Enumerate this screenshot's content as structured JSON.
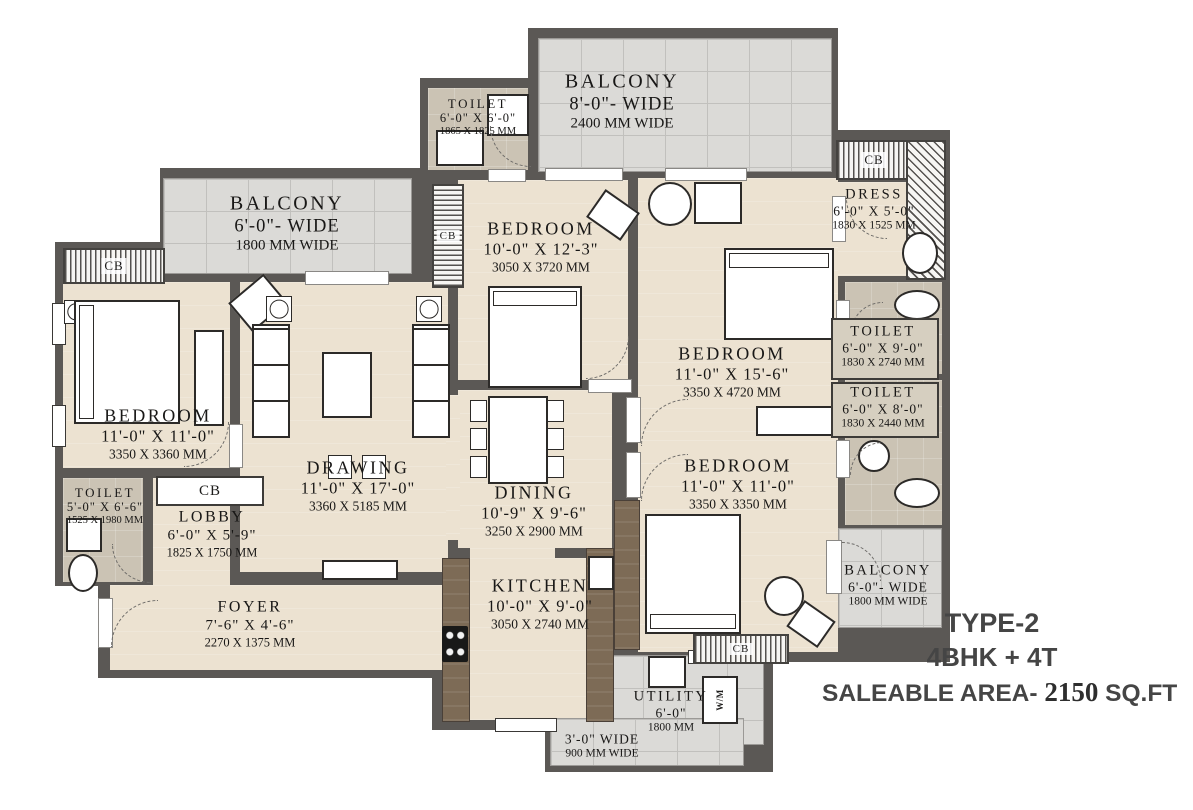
{
  "rooms": {
    "toilet_top": {
      "name": "TOILET",
      "dims_ft": "6'-0\" X 6'-0\"",
      "dims_mm": "1865 X 1825 MM"
    },
    "balcony_top": {
      "name": "BALCONY",
      "dims_ft": "8'-0\"- WIDE",
      "dims_mm": "2400 MM WIDE"
    },
    "dress": {
      "name": "DRESS",
      "dims_ft": "6'-0\" X 5'-0\"",
      "dims_mm": "1830 X 1525 MM"
    },
    "balcony_left": {
      "name": "BALCONY",
      "dims_ft": "6'-0\"- WIDE",
      "dims_mm": "1800 MM WIDE"
    },
    "bedroom_top": {
      "name": "BEDROOM",
      "dims_ft": "10'-0\" X 12'-3\"",
      "dims_mm": "3050 X 3720 MM"
    },
    "bedroom_right": {
      "name": "BEDROOM",
      "dims_ft": "11'-0\" X 15'-6\"",
      "dims_mm": "3350 X 4720 MM"
    },
    "toilet_right_1": {
      "name": "TOILET",
      "dims_ft": "6'-0\" X 9'-0\"",
      "dims_mm": "1830 X 2740 MM"
    },
    "toilet_right_2": {
      "name": "TOILET",
      "dims_ft": "6'-0\" X 8'-0\"",
      "dims_mm": "1830 X 2440 MM"
    },
    "bedroom_left": {
      "name": "BEDROOM",
      "dims_ft": "11'-0\" X 11'-0\"",
      "dims_mm": "3350 X 3360 MM"
    },
    "drawing": {
      "name": "DRAWING",
      "dims_ft": "11'-0\" X 17'-0\"",
      "dims_mm": "3360 X 5185 MM"
    },
    "dining": {
      "name": "DINING",
      "dims_ft": "10'-9\" X 9'-6\"",
      "dims_mm": "3250 X 2900 MM"
    },
    "bedroom_bottom": {
      "name": "BEDROOM",
      "dims_ft": "11'-0\" X 11'-0\"",
      "dims_mm": "3350 X 3350 MM"
    },
    "toilet_left": {
      "name": "TOILET",
      "dims_ft": "5'-0\" X 6'-6\"",
      "dims_mm": "1525 X 1980 MM"
    },
    "lobby": {
      "name": "LOBBY",
      "dims_ft": "6'-0\" X 5'-9\"",
      "dims_mm": "1825 X 1750 MM"
    },
    "foyer": {
      "name": "FOYER",
      "dims_ft": "7'-6\" X 4'-6\"",
      "dims_mm": "2270 X 1375 MM"
    },
    "kitchen": {
      "name": "KITCHEN",
      "dims_ft": "10'-0\" X 9'-0\"",
      "dims_mm": "3050 X 2740 MM"
    },
    "balcony_right": {
      "name": "BALCONY",
      "dims_ft": "6'-0\"- WIDE",
      "dims_mm": "1800 MM WIDE"
    },
    "utility": {
      "name": "UTILITY",
      "dims_ft": "6'-0\"",
      "dims_mm": "1800 MM"
    },
    "passage_bottom": {
      "dims_ft": "3'-0\" WIDE",
      "dims_mm": "900 MM WIDE"
    }
  },
  "labels": {
    "cb": "CB",
    "wm": "W/M"
  },
  "title_block": {
    "line1": "TYPE-2",
    "line2": "4BHK + 4T",
    "line3_prefix": "SALEABLE AREA- ",
    "line3_value": "2150",
    "line3_suffix": " SQ.FT"
  },
  "colors": {
    "wall": "#5b5855",
    "floor": "#ece2d1",
    "toilet_floor": "#cbc3b4",
    "balcony_tile": "#dbdad7",
    "counter": "#7d6b56",
    "title_text": "#454545"
  }
}
